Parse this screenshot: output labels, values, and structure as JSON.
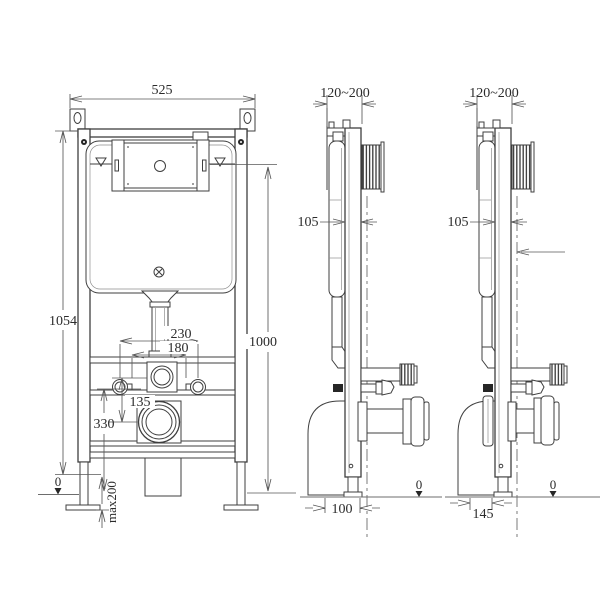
{
  "front": {
    "dim_width": "525",
    "dim_total_height": "1054",
    "dim_flush_height": "1000",
    "dim_bolt_spacing_outer": "230",
    "dim_bolt_spacing_inner": "180",
    "dim_inlet_to_outlet": "135",
    "dim_outlet_height": "330",
    "floor_zero": "0",
    "dim_leg_adjust": "max200"
  },
  "side_a": {
    "dim_wall_offset": "120~200",
    "dim_depth": "105",
    "dim_outlet_offset": "100",
    "floor_zero": "0"
  },
  "side_b": {
    "dim_wall_offset": "120~200",
    "dim_depth": "105",
    "dim_outlet_offset": "145",
    "floor_zero": "0"
  }
}
